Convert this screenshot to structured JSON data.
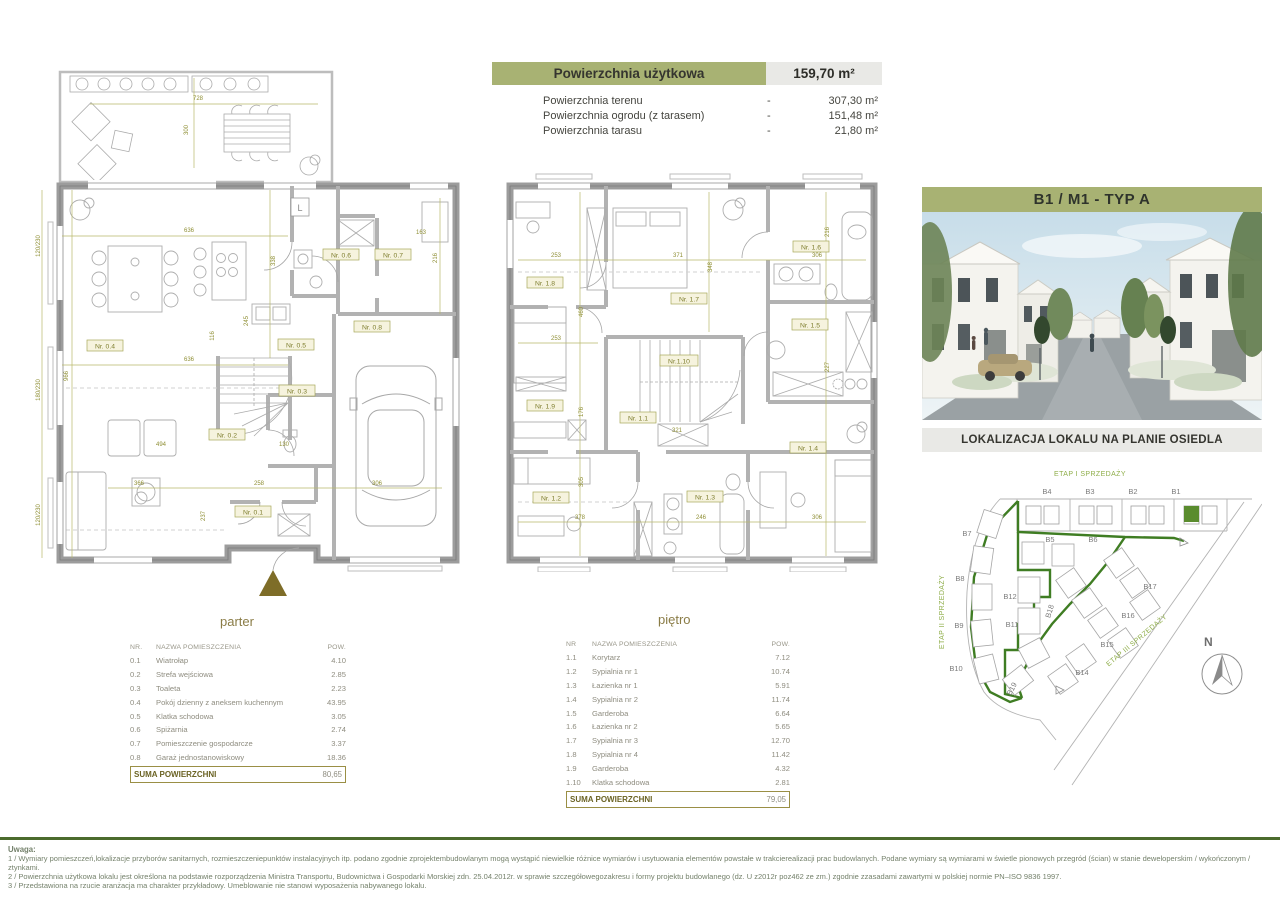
{
  "summary": {
    "usable_label": "Powierzchnia użytkowa",
    "usable_value": "159,70 m²",
    "rows": [
      {
        "label": "Powierzchnia terenu",
        "dash": "-",
        "value": "307,30 m²"
      },
      {
        "label": "Powierzchnia ogrodu (z tarasem)",
        "dash": "-",
        "value": "151,48 m²"
      },
      {
        "label": "Powierzchnia tarasu",
        "dash": "-",
        "value": "21,80 m²"
      }
    ]
  },
  "unit": {
    "title": "B1 / M1 - TYP A",
    "location_caption": "LOKALIZACJA LOKALU NA PLANIE OSIEDLA"
  },
  "plans": {
    "parter": {
      "title": "parter",
      "fridge_label": "L",
      "rooms": [
        "Nr. 0.1",
        "Nr. 0.2",
        "Nr. 0.3",
        "Nr. 0.4",
        "Nr. 0.5",
        "Nr. 0.6",
        "Nr. 0.7",
        "Nr. 0.8"
      ],
      "dims": [
        "728",
        "300",
        "636",
        "338",
        "163",
        "216",
        "245",
        "116",
        "966",
        "636",
        "494",
        "366",
        "258",
        "306",
        "130",
        "237",
        "120/230",
        "180/230",
        "120/230"
      ]
    },
    "pietro": {
      "title": "piętro",
      "rooms": [
        "Nr. 1.1",
        "Nr. 1.2",
        "Nr. 1.3",
        "Nr. 1.4",
        "Nr. 1.5",
        "Nr. 1.6",
        "Nr. 1.7",
        "Nr. 1.8",
        "Nr. 1.9",
        "Nr.1.10"
      ],
      "dims": [
        "253",
        "371",
        "348",
        "306",
        "216",
        "460",
        "176",
        "253",
        "321",
        "378",
        "246",
        "306",
        "305",
        "227"
      ]
    }
  },
  "tables": {
    "parter": {
      "headers": {
        "nr": "NR.",
        "name": "NAZWA POMIESZCZENIA",
        "area": "POW."
      },
      "rows": [
        [
          "0.1",
          "Wiatrołap",
          "4.10"
        ],
        [
          "0.2",
          "Strefa wejściowa",
          "2.85"
        ],
        [
          "0.3",
          "Toaleta",
          "2.23"
        ],
        [
          "0.4",
          "Pokój dzienny z aneksem kuchennym",
          "43.95"
        ],
        [
          "0.5",
          "Klatka schodowa",
          "3.05"
        ],
        [
          "0.6",
          "Spiżarnia",
          "2.74"
        ],
        [
          "0.7",
          "Pomieszczenie gospodarcze",
          "3.37"
        ],
        [
          "0.8",
          "Garaż jednostanowiskowy",
          "18.36"
        ]
      ],
      "sum_label": "SUMA POWIERZCHNI",
      "sum_value": "80,65"
    },
    "pietro": {
      "headers": {
        "nr": "NR",
        "name": "NAZWA POMIESZCZENIA",
        "area": "POW."
      },
      "rows": [
        [
          "1.1",
          "Korytarz",
          "7.12"
        ],
        [
          "1.2",
          "Sypialnia nr 1",
          "10.74"
        ],
        [
          "1.3",
          "Łazienka nr 1",
          "5.91"
        ],
        [
          "1.4",
          "Sypialnia nr 2",
          "11.74"
        ],
        [
          "1.5",
          "Garderoba",
          "6.64"
        ],
        [
          "1.6",
          "Łazienka nr 2",
          "5.65"
        ],
        [
          "1.7",
          "Sypialnia nr 3",
          "12.70"
        ],
        [
          "1.8",
          "Sypialnia nr 4",
          "11.42"
        ],
        [
          "1.9",
          "Garderoba",
          "4.32"
        ],
        [
          "1.10",
          "Klatka schodowa",
          "2.81"
        ]
      ],
      "sum_label": "SUMA POWIERZCHNI",
      "sum_value": "79,05"
    }
  },
  "site": {
    "stage1": "ETAP I SPRZEDAŻY",
    "stage2": "ETAP II SPRZEDAŻY",
    "stage3": "ETAP III SPRZEDAŻY",
    "north": "N",
    "highlighted_lot": "B1",
    "lots": [
      "B1",
      "B2",
      "B3",
      "B4",
      "B5",
      "B6",
      "B7",
      "B8",
      "B9",
      "B10",
      "B11",
      "B12",
      "B14",
      "B15",
      "B16",
      "B17",
      "B18",
      "B19"
    ]
  },
  "footer": {
    "title": "Uwaga:",
    "notes": [
      "1 / Wymiary pomieszczeń,lokalizacje przyborów sanitarnych,  rozmieszczeniepunktów instalacyjnych  itp.  podano zgodnie zprojektembudowlanym   mogą wystąpić niewielkie  różnice wymiarów i usytuowania  elementów  powstałe w trakcierealizacji   prac budowlanych. Podane wymiary  są wymiarami w świetle  pionowych przegród (ścian) w stanie  deweloperskim   / wykończonym / ztynkami.",
      "2 / Powierzchnia  użytkowa lokalu  jest określona  na podstawie  rozporządzenia Ministra   Transportu,  Budownictwa   i Gospodarki  Morskiej  zdn.  25.04.2012r. w sprawie  szczegółowegozakresu i formy  projektu  budowlanego  (dz. U z2012r poz462  ze zm.) zgodnie  zzasadami  zawartymi  w polskiej  normie  PN–ISO 9836 1997.",
      "3 / Przedstawiona na rzucie aranżacja ma charakter  przykładowy. Umeblowanie  nie stanowi  wyposażenia nabywanego lokalu."
    ]
  },
  "colors": {
    "olive_bar": "#a8b273",
    "light_bar": "#e9e9e6",
    "site_green": "#3f7d23",
    "stage_green": "#8fae4a",
    "highlight_green": "#5a8c2e",
    "dim_olive": "#9a9a3c",
    "footer_rule": "#4b6b2d"
  }
}
